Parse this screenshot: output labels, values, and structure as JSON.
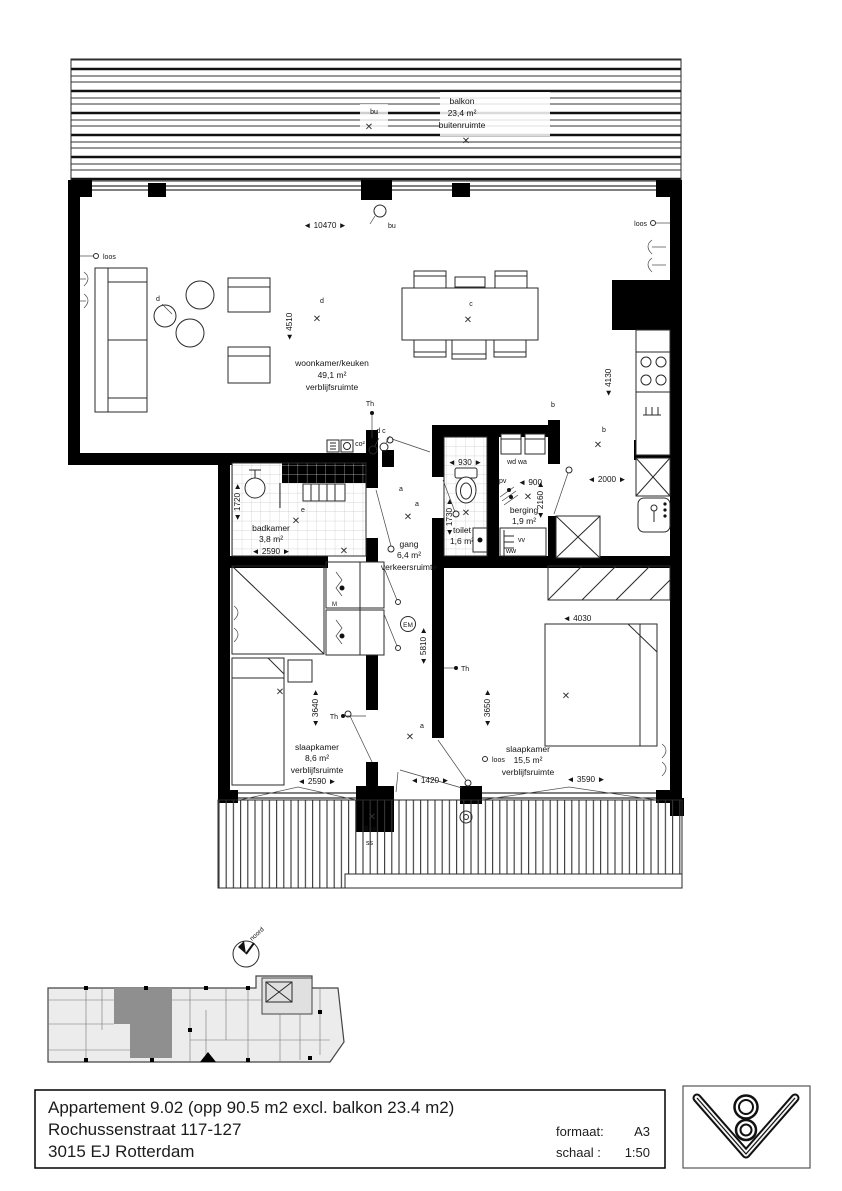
{
  "rooms": {
    "balkon": {
      "name": "balkon",
      "area": "23,4 m²",
      "type": "buitenruimte"
    },
    "woonkamer": {
      "name": "woonkamer/keuken",
      "area": "49,1 m²",
      "type": "verblijfsruimte"
    },
    "badkamer": {
      "name": "badkamer",
      "area": "3,8 m²"
    },
    "gang": {
      "name": "gang",
      "area": "6,4 m²",
      "type": "verkeersruimte"
    },
    "toilet": {
      "name": "toilet",
      "area": "1,6 m²"
    },
    "berging": {
      "name": "berging",
      "area": "1,9 m²"
    },
    "slaapkamer1": {
      "name": "slaapkamer",
      "area": "8,6 m²",
      "type": "verblijfsruimte"
    },
    "slaapkamer2": {
      "name": "slaapkamer",
      "area": "15,5 m²",
      "type": "verblijfsruimte"
    }
  },
  "dims": {
    "w10470": "◄ 10470 ►",
    "h4510": "◄ 4510",
    "h4130": "◄ 4130",
    "w2000": "◄ 2000 ►",
    "w2590": "◄ 2590 ►",
    "h1720": "◄ 1720 ►",
    "w930": "◄ 930 ►",
    "h1730": "◄ 1730 ►",
    "w900": "◄ 900",
    "h2160": "◄ 2160 ►",
    "h3640": "◄ 3640 ►",
    "w1420": "◄ 1420 ►",
    "h5810": "◄ 5810 ►",
    "h3650": "◄ 3650 ►",
    "w4030": "◄ 4030",
    "w3590": "◄ 3590 ►"
  },
  "ann": {
    "cross": "✕",
    "a": "a",
    "b": "b",
    "c": "c",
    "d": "d",
    "e": "e",
    "dc": "d c",
    "th": "Th",
    "em": "EM",
    "bu": "bu",
    "loos": "loos",
    "co2": "co²",
    "pv": "pv",
    "vv": "vv",
    "ww": "ww",
    "wdwa": "wd wa",
    "m": "M",
    "bnv": "Bnv",
    "ss": "ss",
    "noord": "noord"
  },
  "titleblock": {
    "line1": "Appartement 9.02 (opp 90.5 m2 excl. balkon 23.4 m2)",
    "line2": "Rochussenstraat 117-127",
    "line3": "3015 EJ Rotterdam",
    "formaat_label": "formaat:",
    "formaat_value": "A3",
    "schaal_label": "schaal :",
    "schaal_value": "1:50"
  },
  "logo": {
    "digit": "8"
  },
  "colors": {
    "wall": "#000000",
    "tile_line": "#c9c9c9",
    "site_unit": "#8f8f8f",
    "site_fill": "#ececec"
  }
}
